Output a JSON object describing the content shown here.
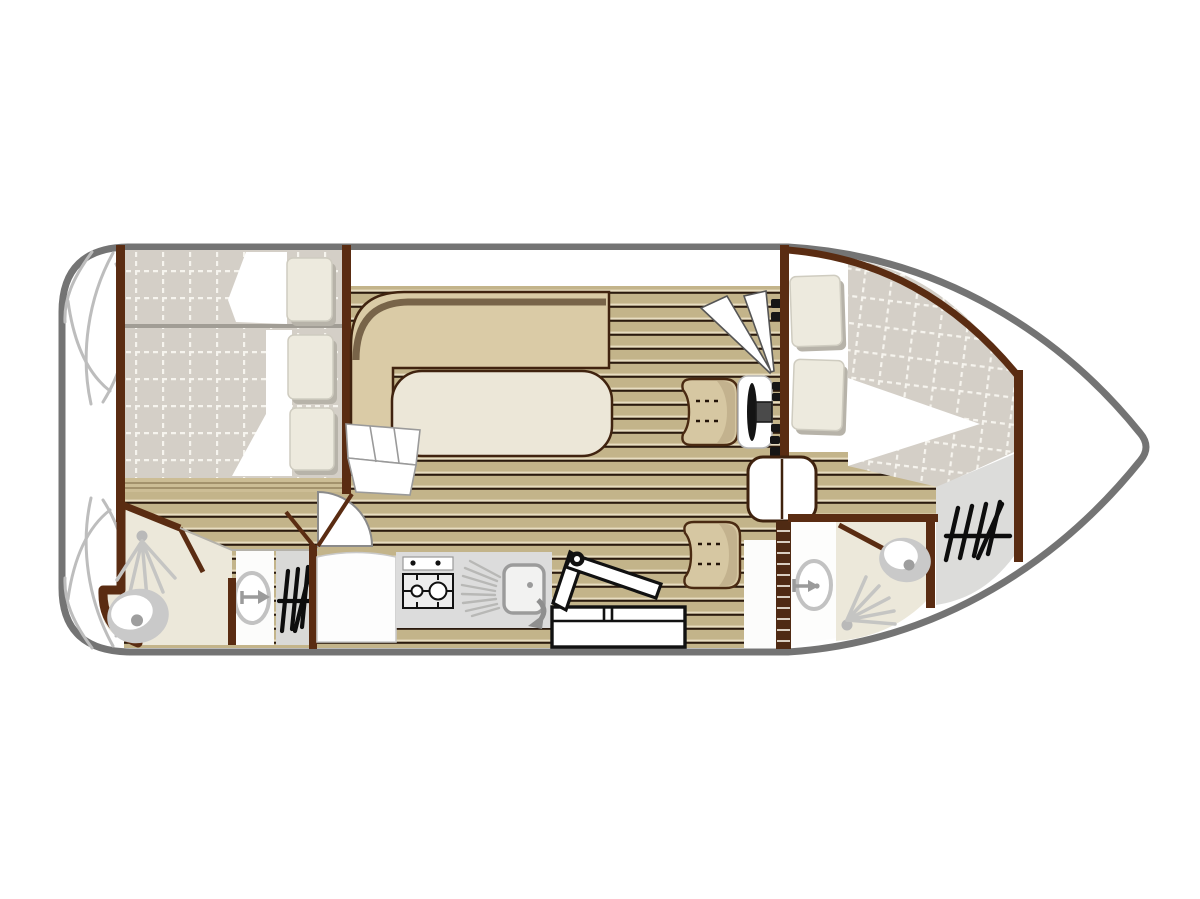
{
  "meta": {
    "title": "Houseboat deck plan",
    "type": "floor-plan-diagram",
    "orientation": "bow-right-stern-left",
    "text_on_image": ""
  },
  "colors": {
    "background": "#ffffff",
    "hull_outline": "#747474",
    "interior_wall": "#5a2c12",
    "floor_plank": "#c3b48a",
    "plank_seam": "#2a1a0e",
    "plank_highlight": "#e7ddc1",
    "mattress_quilt": "#d4cfc7",
    "quilt_stitch": "#f6f4ee",
    "cabin_step": "#ccbd95",
    "sofa": "#dacba6",
    "sofa_trim": "#786449",
    "table": "#ece7d8",
    "seat_tan": "#d6c7a2",
    "seat_shade": "#bcab87",
    "pillow": "#edeade",
    "pillow_shadow": "#b7b3a9",
    "bathroom_floor": "#ece8da",
    "galley_counter": "#dcdcdc",
    "deck_gray": "#dcdcda",
    "fixture_gray": "#c9c9c9",
    "spray_gray": "#c5c5c3",
    "steps_icon_black": "#0d0d0d",
    "door_leaf_white": "#ffffff",
    "fan_arc_gray": "#bdbdbd"
  },
  "rooms": [
    {
      "id": "stern-deck",
      "label": "stern deck",
      "fixtures": [
        "curved transom steps"
      ]
    },
    {
      "id": "aft-cabin",
      "label": "aft cabin",
      "fixtures": [
        "single berth",
        "double berth",
        "three pillows",
        "entry step"
      ]
    },
    {
      "id": "aft-bathroom",
      "label": "aft bathroom",
      "fixtures": [
        "shower",
        "toilet",
        "washbasin"
      ]
    },
    {
      "id": "companionway-aft",
      "label": "aft companionway",
      "fixtures": [
        "steps icon"
      ]
    },
    {
      "id": "saloon",
      "label": "saloon",
      "fixtures": [
        "L-shaped sofa",
        "dining table",
        "steps",
        "door swing"
      ]
    },
    {
      "id": "galley",
      "label": "galley",
      "fixtures": [
        "refrigerator",
        "two-burner hob",
        "sink with drainer",
        "folding steps",
        "bench chest"
      ]
    },
    {
      "id": "helm",
      "label": "helm station",
      "fixtures": [
        "helm seat",
        "steering wheel",
        "instrument knobs",
        "windscreen leaves"
      ]
    },
    {
      "id": "dinette",
      "label": "dinette",
      "fixtures": [
        "second seat",
        "double swing door",
        "wall ladder"
      ]
    },
    {
      "id": "bow-cabin",
      "label": "bow cabin",
      "fixtures": [
        "double berth",
        "two pillows"
      ]
    },
    {
      "id": "bow-bathroom",
      "label": "bow bathroom",
      "fixtures": [
        "washbasin",
        "toilet",
        "shower"
      ]
    },
    {
      "id": "bow-deck",
      "label": "bow deck",
      "fixtures": [
        "boarding steps icon"
      ]
    }
  ],
  "icons": [
    {
      "name": "steps-icon",
      "meaning": "steps / boarding ladder symbol"
    },
    {
      "name": "shower-spray-icon",
      "meaning": "shower head with spray"
    },
    {
      "name": "faucet-arrow-icon",
      "meaning": "washbasin tap"
    },
    {
      "name": "steering-wheel-icon",
      "meaning": "helm wheel"
    }
  ]
}
